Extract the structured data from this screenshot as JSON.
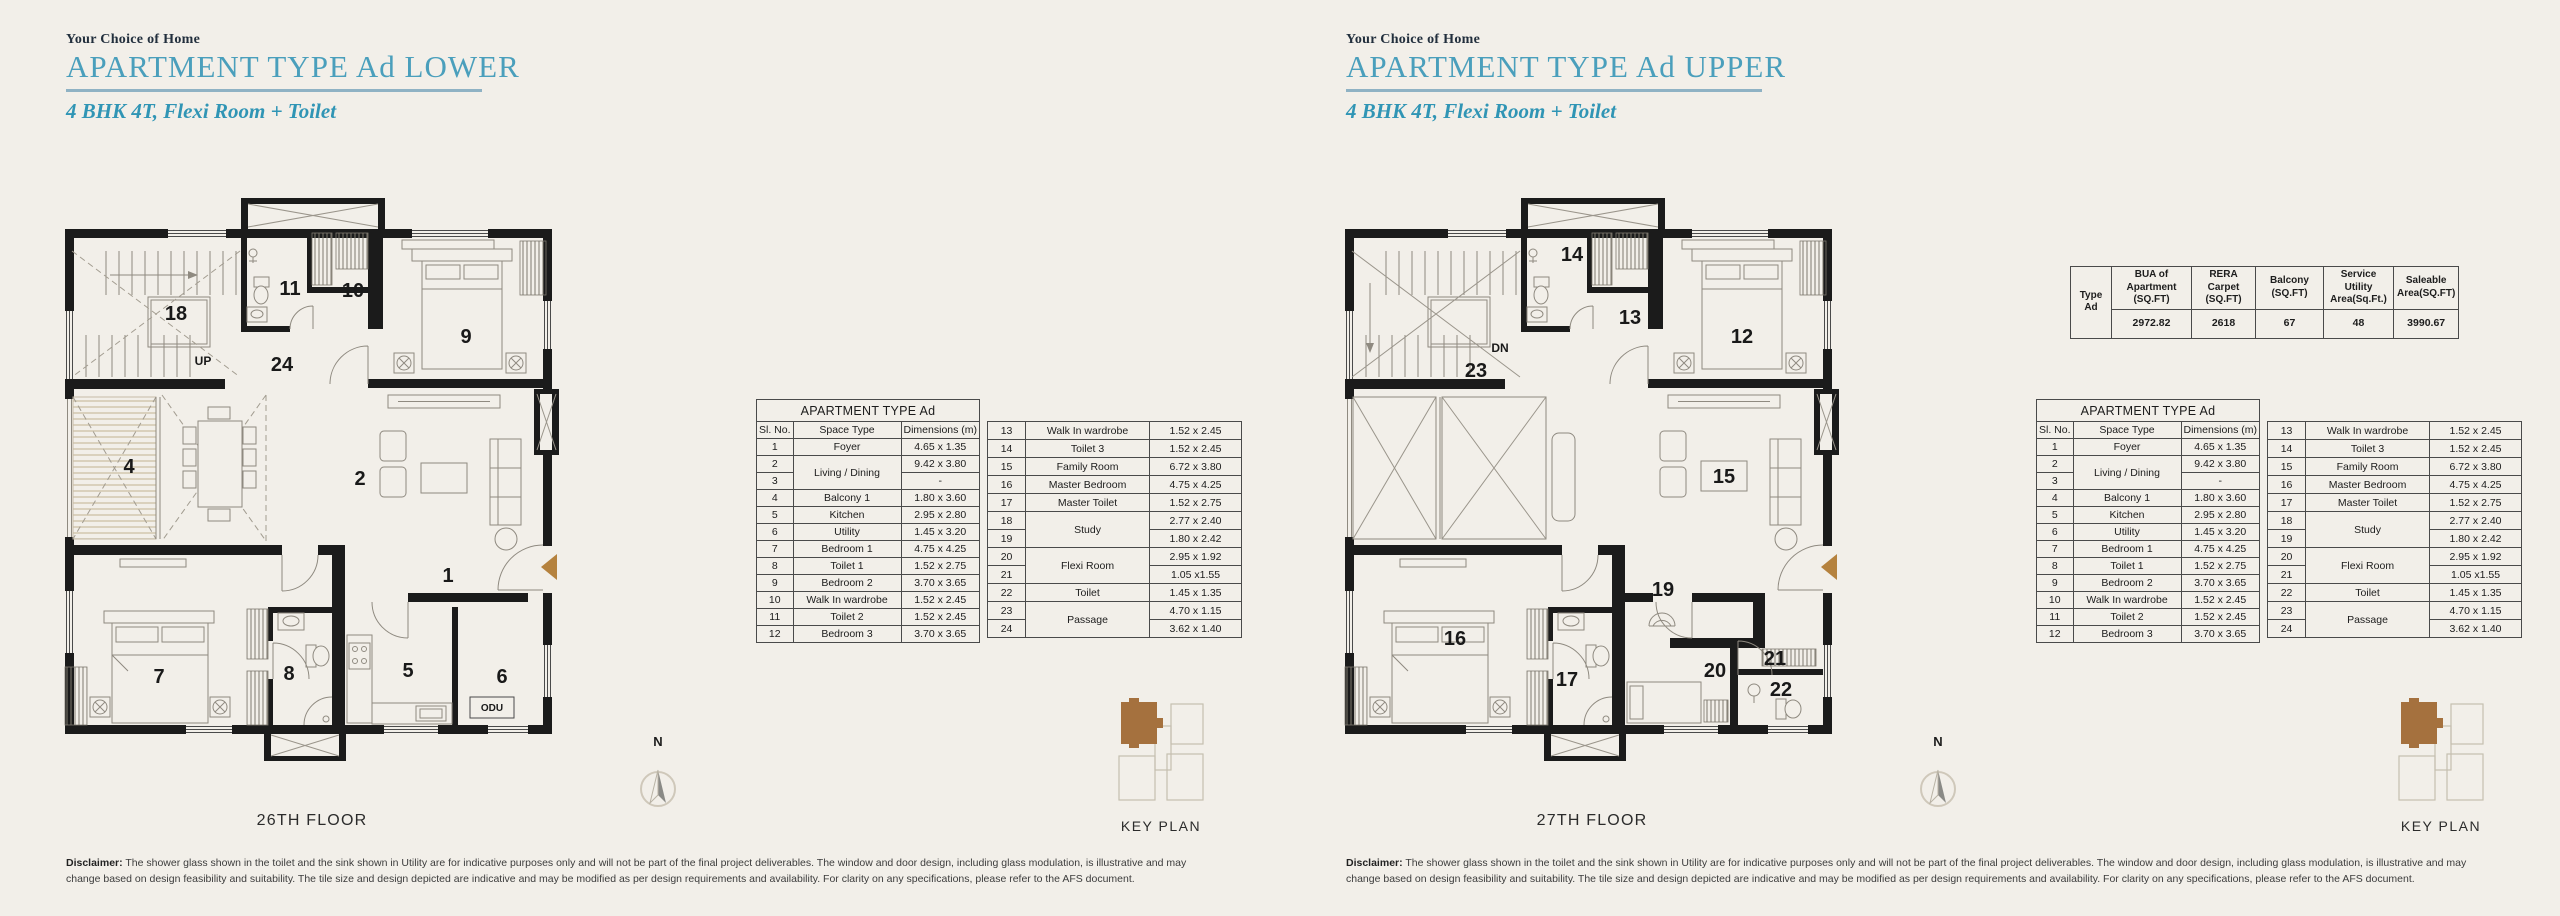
{
  "page": {
    "background": "#f2efe9",
    "accent": "#4a9fbc",
    "brown": "#a5713e"
  },
  "panels": {
    "lower": {
      "eyebrow": "Your Choice of Home",
      "title": "APARTMENT TYPE Ad LOWER",
      "subtitle": "4 BHK 4T, Flexi Room + Toilet",
      "floor": "26TH FLOOR"
    },
    "upper": {
      "eyebrow": "Your Choice of Home",
      "title": "APARTMENT TYPE Ad UPPER",
      "subtitle": "4 BHK 4T, Flexi Room + Toilet",
      "floor": "27TH FLOOR"
    }
  },
  "plans": {
    "lower": {
      "direction": "UP",
      "labels": {
        "r18": "18",
        "r11": "11",
        "r10": "10",
        "r9": "9",
        "r24": "24",
        "r4": "4",
        "r2": "2",
        "r1": "1",
        "r7": "7",
        "r8": "8",
        "r5": "5",
        "r6": "6",
        "odu": "ODU"
      }
    },
    "upper": {
      "direction": "DN",
      "labels": {
        "r14": "14",
        "r13": "13",
        "r12": "12",
        "r23": "23",
        "r15": "15",
        "r19": "19",
        "r16": "16",
        "r17": "17",
        "r20": "20",
        "r21": "21",
        "r22": "22"
      }
    }
  },
  "tables": {
    "dim": {
      "title": "APARTMENT TYPE Ad",
      "headers": [
        "Sl. No.",
        "Space Type",
        "Dimensions (m)"
      ],
      "left_rows": [
        {
          "no": "1",
          "space": "Foyer",
          "dim": "4.65 x 1.35"
        },
        {
          "no": "2",
          "space": "Living / Dining",
          "dim": "9.42 x 3.80",
          "merge": "start"
        },
        {
          "no": "3",
          "space": "",
          "dim": "-",
          "merge": "end"
        },
        {
          "no": "4",
          "space": "Balcony 1",
          "dim": "1.80 x 3.60"
        },
        {
          "no": "5",
          "space": "Kitchen",
          "dim": "2.95 x 2.80"
        },
        {
          "no": "6",
          "space": "Utility",
          "dim": "1.45 x 3.20"
        },
        {
          "no": "7",
          "space": "Bedroom 1",
          "dim": "4.75 x 4.25"
        },
        {
          "no": "8",
          "space": "Toilet 1",
          "dim": "1.52 x 2.75"
        },
        {
          "no": "9",
          "space": "Bedroom 2",
          "dim": "3.70 x 3.65"
        },
        {
          "no": "10",
          "space": "Walk In wardrobe",
          "dim": "1.52 x 2.45"
        },
        {
          "no": "11",
          "space": "Toilet 2",
          "dim": "1.52 x 2.45"
        },
        {
          "no": "12",
          "space": "Bedroom 3",
          "dim": "3.70 x 3.65"
        }
      ],
      "right_rows": [
        {
          "no": "13",
          "space": "Walk In wardrobe",
          "dim": "1.52 x 2.45"
        },
        {
          "no": "14",
          "space": "Toilet 3",
          "dim": "1.52 x 2.45"
        },
        {
          "no": "15",
          "space": "Family Room",
          "dim": "6.72 x 3.80"
        },
        {
          "no": "16",
          "space": "Master Bedroom",
          "dim": "4.75 x 4.25"
        },
        {
          "no": "17",
          "space": "Master Toilet",
          "dim": "1.52 x 2.75"
        },
        {
          "no": "18",
          "space": "Study",
          "dim": "2.77 x 2.40",
          "merge": "start"
        },
        {
          "no": "19",
          "space": "",
          "dim": "1.80 x 2.42",
          "merge": "end"
        },
        {
          "no": "20",
          "space": "Flexi Room",
          "dim": "2.95 x 1.92",
          "merge": "start"
        },
        {
          "no": "21",
          "space": "",
          "dim": "1.05 x1.55",
          "merge": "end"
        },
        {
          "no": "22",
          "space": "Toilet",
          "dim": "1.45 x 1.35"
        },
        {
          "no": "23",
          "space": "Passage",
          "dim": "4.70 x 1.15",
          "merge": "start"
        },
        {
          "no": "24",
          "space": "",
          "dim": "3.62 x 1.40",
          "merge": "end"
        }
      ]
    },
    "summary": {
      "row_header": "Type Ad",
      "columns": [
        {
          "header": "BUA of Apartment (SQ.FT)",
          "value": "2972.82"
        },
        {
          "header": "RERA Carpet (SQ.FT)",
          "value": "2618"
        },
        {
          "header": "Balcony (SQ.FT)",
          "value": "67"
        },
        {
          "header": "Service Utility Area(Sq.Ft.)",
          "value": "48"
        },
        {
          "header": "Saleable Area(SQ.FT)",
          "value": "3990.67"
        }
      ]
    }
  },
  "key_plan": {
    "label": "KEY PLAN"
  },
  "north": {
    "label": "N"
  },
  "disclaimer": {
    "label": "Disclaimer:",
    "text": " The shower glass shown in the toilet and the sink shown in Utility are for indicative purposes only and will not be part of the final project deliverables. The window and door design, including glass modulation, is illustrative and may change based on design feasibility and suitability. The tile size and design depicted are indicative and may be modified as per design requirements and availability. For clarity on any specifications, please refer to the AFS document."
  }
}
